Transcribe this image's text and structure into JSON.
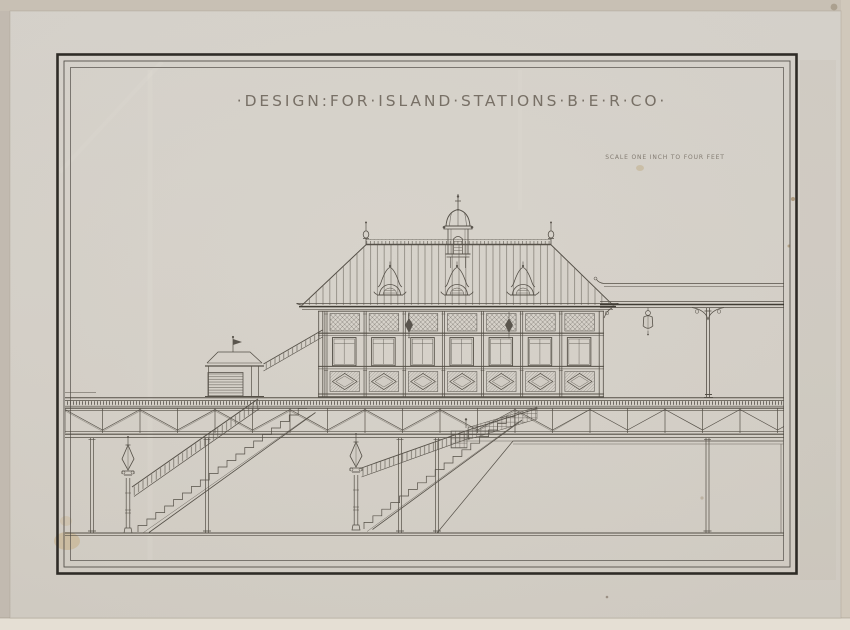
{
  "artwork": {
    "title": "·DESIGN:FOR·ISLAND·STATIONS·B·E·R·CO·",
    "scale_note": "SCALE ONE INCH TO FOUR FEET"
  },
  "colors": {
    "mat": "#c2bab0",
    "mat_top": "#c8c0b4",
    "mat_right": "#d0c8bb",
    "mat_bottom": "#e5dfd4",
    "paper": "#d1ccc4",
    "paper_light": "#d8d4cc",
    "paper_deep": "#cfcac1",
    "ink": "#4e4941",
    "ink_bold": "#38342d",
    "ink_soft": "#544f47",
    "border_dark": "#2f2c27",
    "title_ink": "#6e665c",
    "stain_yellow": "#c2a368",
    "stain_brown": "#8a6a3a"
  }
}
